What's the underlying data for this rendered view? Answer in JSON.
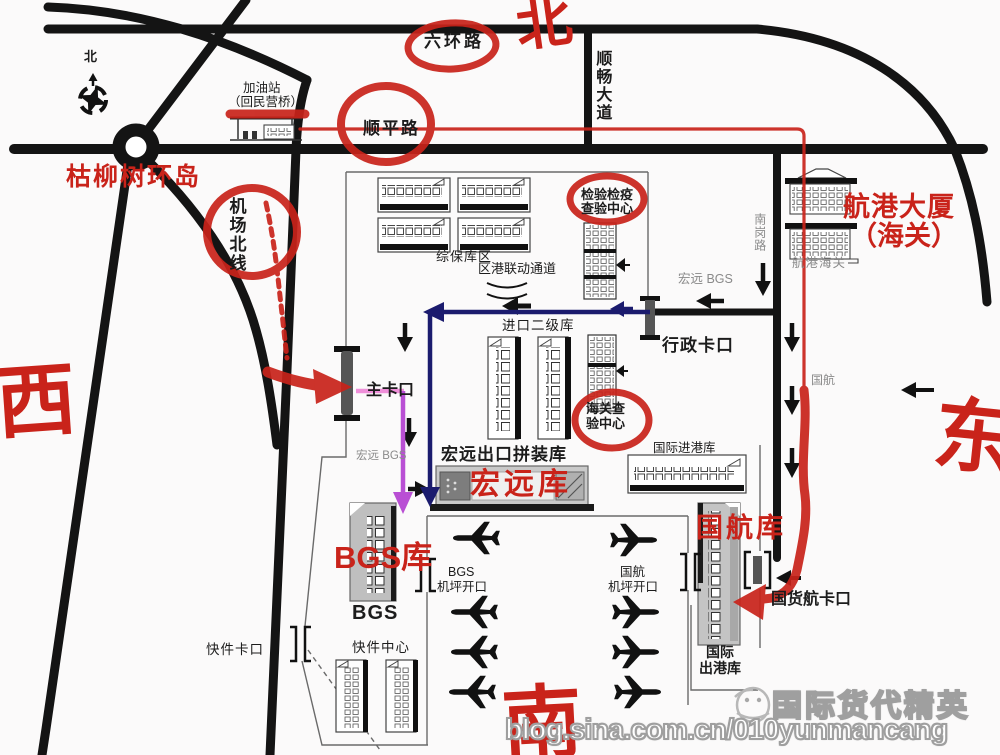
{
  "colors": {
    "road_black": "#141414",
    "annotation_red": "#c9231a",
    "route_blue": "#1b1b6e",
    "route_purple": "#b94fd4",
    "route_pink": "#ef8fd9",
    "gray_text": "#8a8a8a"
  },
  "compass": {
    "small_north": "北"
  },
  "cardinal": {
    "north": "北",
    "west": "西",
    "east": "东",
    "south": "南"
  },
  "roads": {
    "ring6": "六环路",
    "shunchang": "顺畅大道",
    "shunping": "顺平路",
    "airport_north_line": "机场北线",
    "nangang": "南岗路",
    "kuliushu_roundabout": "枯柳树环岛"
  },
  "labels": {
    "gas_station_l1": "加油站",
    "gas_station_l2": "（回民营桥）",
    "hanggang_tower_l1": "航港大厦",
    "hanggang_tower_l2": "（海关）",
    "hanggang_customs": "航港海关",
    "bonded_zone": "综保库区",
    "linkage_channel": "区港联动通道",
    "inspection_l1": "检验检疫",
    "inspection_l2": "查验中心",
    "admin_gate": "行政卡口",
    "hongyuan_bgs_n": "宏远  BGS",
    "import_l2_warehouse": "进口二级库",
    "main_gate": "主卡口",
    "customs_check_l1": "海关查",
    "customs_check_l2": "验中心",
    "hongyuan_bgs_s": "宏远  BGS",
    "hongyuan_export": "宏远出口拼装库",
    "hongyuan_wh": "宏远库",
    "intl_arrival_wh": "国际进港库",
    "ca_gray": "国航",
    "bgs_wh": "BGS库",
    "ca_wh": "国航库",
    "bgs_apron_l1": "BGS",
    "bgs_apron_l2": "机坪开口",
    "ca_apron_l1": "国航",
    "ca_apron_l2": "机坪开口",
    "express_gate": "快件卡口",
    "bgs": "BGS",
    "express_center": "快件中心",
    "intl_departure_l1": "国际",
    "intl_departure_l2": "出港库",
    "cargo_gate": "国货航卡口"
  },
  "watermark": {
    "brand": "国际货代精英",
    "url": "blog.sina.com.cn/010yunmancang"
  }
}
